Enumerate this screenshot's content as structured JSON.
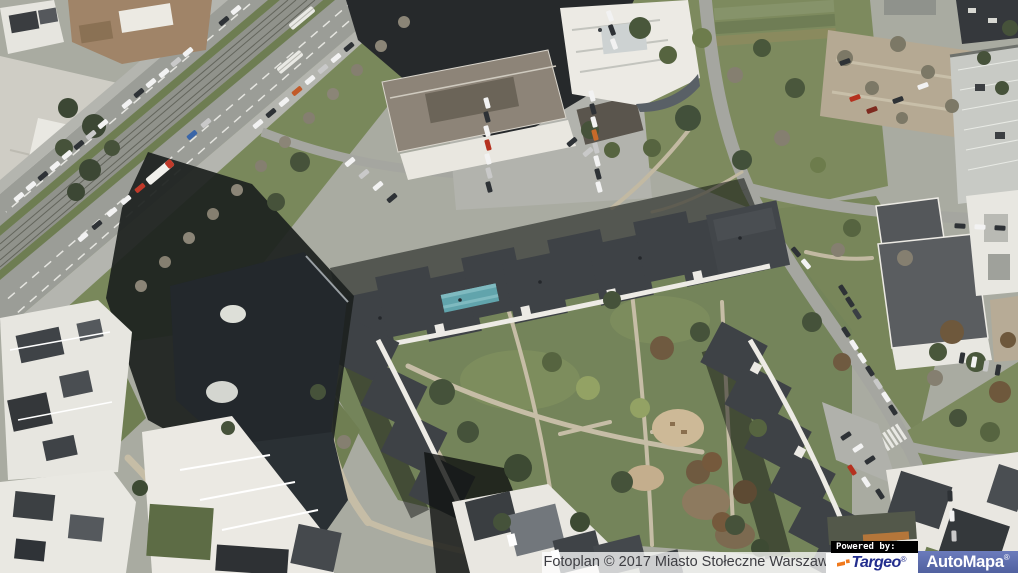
{
  "attribution": {
    "text": "Fotoplan © 2017 Miasto Stołeczne Warszawa"
  },
  "powered_by": {
    "label": "Powered by:",
    "brands": [
      {
        "name": "Targeo",
        "registered_mark": "®"
      },
      {
        "name": "AutoMapa",
        "registered_mark": "®"
      }
    ]
  },
  "colors": {
    "attribution-bg": "rgba(255,255,255,0.75)",
    "attribution-text": "#3d3d42",
    "powered-bg": "#000000",
    "powered-text": "#ffffff",
    "targeo-navy": "#232e8e",
    "targeo-orange": "#f07a1e",
    "automapa-bg-top": "#6b7bbc",
    "automapa-bg-bottom": "#51619f",
    "automapa-text": "#ffffff"
  }
}
